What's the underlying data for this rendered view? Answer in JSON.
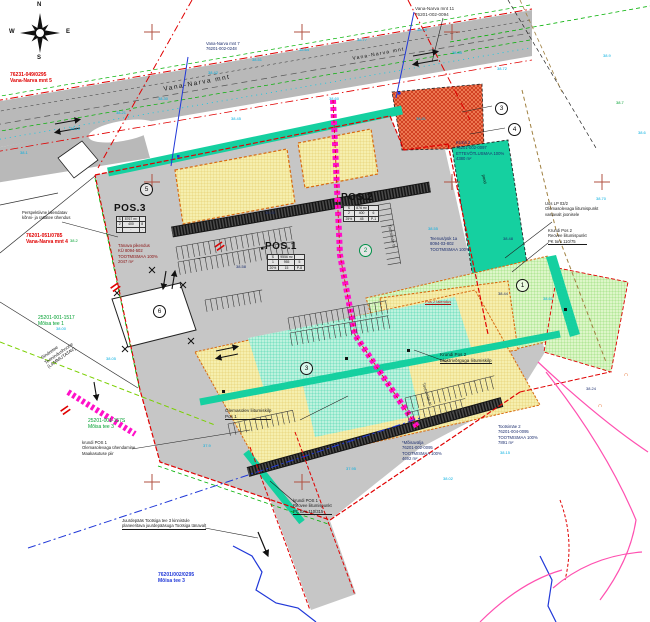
{
  "map": {
    "compass": {
      "n": "N",
      "e": "E",
      "s": "S",
      "w": "W"
    },
    "pos": {
      "pos1": {
        "label": "POS.1",
        "table": [
          [
            "S",
            "9556 m²",
            ""
          ],
          [
            "1",
            "955",
            "5"
          ],
          [
            "20%",
            "15",
            "P-8"
          ]
        ]
      },
      "pos2": {
        "label": "POS.2",
        "table": [
          [
            "S",
            "876 m²",
            ""
          ],
          [
            "2",
            "400",
            "6"
          ],
          [
            "25%",
            "45",
            "P-1"
          ]
        ]
      },
      "pos3": {
        "label": "POS.3",
        "table": [
          [
            "S",
            "8767 m²",
            ""
          ],
          [
            "2",
            "400",
            "8"
          ],
          [
            "·",
            "·",
            "·"
          ]
        ]
      }
    },
    "annotations": [
      {
        "n": "label-vana-narva-mnt-5",
        "x": 10,
        "y": 72,
        "c": "#e00000",
        "s": 5,
        "b": 1,
        "lines": [
          "76231-049/0295",
          "Vana-Narva mnt 5"
        ]
      },
      {
        "n": "label-vana-narva-mnt-4",
        "x": 26,
        "y": 233,
        "c": "#e00000",
        "s": 5,
        "b": 1,
        "lines": [
          "76201-051/0785",
          "Vana-Narva mnt 4"
        ]
      },
      {
        "n": "label-moisa-tee-1",
        "x": 38,
        "y": 315,
        "c": "#00a030",
        "s": 5,
        "lines": [
          "25201-001-1517",
          "Mõisa tee 1"
        ]
      },
      {
        "n": "label-moisa-tee-3-green",
        "x": 88,
        "y": 418,
        "c": "#00a030",
        "s": 5,
        "lines": [
          "25201-001-157S",
          "Mõisa tee 3"
        ]
      },
      {
        "n": "label-moisa-tee-3-blue",
        "x": 158,
        "y": 572,
        "c": "#2038d8",
        "s": 5,
        "b": 1,
        "lines": [
          "76201/002/0295",
          "Mõisa tee 3"
        ]
      },
      {
        "n": "label-vana-narva-mnt-11",
        "x": 415,
        "y": 6,
        "c": "#303030",
        "s": 4.6,
        "lines": [
          "Vana-Narva mnt 11",
          "76201-002-0094"
        ]
      },
      {
        "n": "label-vana-narva-mnt-7",
        "x": 206,
        "y": 41,
        "c": "#1c2e6e",
        "s": 4.2,
        "lines": [
          "Vana-Narva mnt 7",
          "76201-002-0248"
        ]
      },
      {
        "n": "label-krohli-2",
        "x": 456,
        "y": 140,
        "c": "#1c2e6e",
        "s": 4.2,
        "lines": [
          "Krohli 2",
          "76201-002-0097",
          "ETTEVÕTLUSMAA 100%",
          "4380 m²"
        ]
      },
      {
        "n": "label-teenuspuk-1a",
        "x": 430,
        "y": 236,
        "c": "#1c2e6e",
        "s": 4.2,
        "lines": [
          "Teenus/pük 1a",
          "8094-03-802",
          "TOOTMISMAA 100%"
        ]
      },
      {
        "n": "label-uus-lp",
        "x": 545,
        "y": 201,
        "c": "#1a1a1a",
        "s": 4.2,
        "lines": [
          "Uus LP 03/2",
          "Olemasolevaga liitumispunkt",
          "vastavalt joonisele"
        ]
      },
      {
        "n": "label-pos2-reovee",
        "x": 548,
        "y": 228,
        "c": "#1a1a1a",
        "s": 4.2,
        "u": 1,
        "lines": [
          "Krundi Pos 2",
          "Reovee liitumispunkt",
          "PK toru 110/75"
        ]
      },
      {
        "n": "label-pos2-elekter",
        "x": 440,
        "y": 352,
        "c": "#1a1a1a",
        "s": 4.6,
        "u": 1,
        "lines": [
          "Krundi Pos 2",
          "Elektrivõrguga liitumiskilp"
        ]
      },
      {
        "n": "label-olemasolev-kilp",
        "x": 225,
        "y": 408,
        "c": "#1a1a1a",
        "s": 4.6,
        "u": 1,
        "lines": [
          "Olemasolev liitumiskilp",
          "Pos 1"
        ]
      },
      {
        "n": "label-pos1-reovee",
        "x": 293,
        "y": 498,
        "c": "#1a1a1a",
        "s": 4.2,
        "u": 1,
        "lines": [
          "krundi POS 1",
          "Reovee liitumispunkt",
          "PC toru 110/315"
        ]
      },
      {
        "n": "label-tootsimae-2",
        "x": 498,
        "y": 424,
        "c": "#1c2e6e",
        "s": 4.2,
        "lines": [
          "Tootsimäe 2",
          "76201-004-0095",
          "TOOTMISMAA 100%",
          "7891 m²"
        ]
      },
      {
        "n": "label-moisavalja",
        "x": 402,
        "y": 440,
        "c": "#1c2e6e",
        "s": 4.2,
        "lines": [
          "*Mõisavälja",
          "76201-002-0095",
          "TOOTMISMAA 100%",
          "4692 m²"
        ]
      },
      {
        "n": "label-perspektiivne",
        "x": 22,
        "y": 210,
        "c": "#1a1a1a",
        "s": 4.2,
        "lines": [
          "Perspektiivne laiendatav",
          "kõnni- ja rattatee ühendus"
        ]
      },
      {
        "n": "label-tanava-pikendus",
        "x": 118,
        "y": 243,
        "c": "#8a1010",
        "s": 4.2,
        "lines": [
          "Tänava pikendus",
          "KÜ 8094-502",
          "TOOTMISMAA 100%",
          "2047 m²"
        ]
      },
      {
        "n": "label-juurdepaas",
        "x": 122,
        "y": 518,
        "c": "#1a1a1a",
        "s": 4.2,
        "u": 1,
        "lines": [
          "Juurdepääs Tootsiga tee 3 kinnistule",
          "planeeritava juurdepääsuga Tootsiga tänavalt"
        ]
      },
      {
        "n": "label-pos1-uhendamine",
        "x": 82,
        "y": 440,
        "c": "#1a1a1a",
        "s": 4.2,
        "lines": [
          "krundi POS 1",
          "Olemasolevaga ühendamine",
          "Maakasutuse piir"
        ]
      },
      {
        "n": "label-sindretee",
        "x": 40,
        "y": 356,
        "c": "#1a1a1a",
        "s": 4.6,
        "r": -35,
        "lines": [
          "Sindretee",
          "Teenindushoone",
          "(LAMMUTATAV)"
        ]
      },
      {
        "n": "label-road-name",
        "x": 163,
        "y": 86,
        "c": "#111111",
        "s": 6.5,
        "r": -10.5,
        "sp": 1.5,
        "lines": [
          "Vana-Narva  mnt"
        ]
      },
      {
        "n": "label-road-name-2",
        "x": 352,
        "y": 56,
        "c": "#111111",
        "s": 5,
        "r": -10.5,
        "sp": 1.2,
        "lines": [
          "Vana-Narva  mnt"
        ]
      },
      {
        "n": "label-tootsimae-tn",
        "x": 392,
        "y": 224,
        "c": "#333333",
        "s": 4.2,
        "r": 78,
        "lines": [
          "Tootsimäe tn"
        ]
      },
      {
        "n": "label-tootsimae-tn-2",
        "x": 426,
        "y": 382,
        "c": "#333333",
        "s": 4.2,
        "r": 72,
        "lines": [
          "Tootsimäe tn"
        ]
      },
      {
        "n": "label-pood",
        "x": 486,
        "y": 174,
        "c": "#111111",
        "s": 4.2,
        "r": 78,
        "lines": [
          "pood"
        ]
      },
      {
        "n": "label-pos2-laiendus",
        "x": 425,
        "y": 299,
        "c": "#b01010",
        "s": 4,
        "u": 1,
        "lines": [
          "Pos 2 laiendus"
        ]
      },
      {
        "n": "utility-symbol-1",
        "x": 624,
        "y": 372,
        "c": "#e05000",
        "s": 6,
        "lines": [
          "∩"
        ]
      },
      {
        "n": "utility-symbol-2",
        "x": 598,
        "y": 403,
        "c": "#e05000",
        "s": 6,
        "lines": [
          "∩"
        ]
      }
    ],
    "spot_elevations": [
      [
        208,
        70,
        "38.42"
      ],
      [
        252,
        57,
        "38.51"
      ],
      [
        299,
        47,
        "38.64"
      ],
      [
        357,
        37,
        "38.77"
      ],
      [
        417,
        27,
        "38.90"
      ],
      [
        452,
        50,
        "38.85"
      ],
      [
        497,
        66,
        "38.72"
      ],
      [
        158,
        96,
        "38.30"
      ],
      [
        116,
        110,
        "38.21"
      ],
      [
        70,
        126,
        "38.10"
      ],
      [
        231,
        116,
        "38.45"
      ],
      [
        329,
        96,
        "38.60"
      ],
      [
        265,
        210,
        "38.40",
        "#1c2e6e"
      ],
      [
        428,
        226,
        "38.55"
      ],
      [
        503,
        236,
        "38.48",
        "#1c2e6e"
      ],
      [
        543,
        296,
        "38.61"
      ],
      [
        596,
        196,
        "38.70"
      ],
      [
        346,
        466,
        "37.95"
      ],
      [
        443,
        476,
        "38.02"
      ],
      [
        500,
        450,
        "38.15"
      ],
      [
        106,
        356,
        "38.05"
      ],
      [
        56,
        326,
        "38.00"
      ],
      [
        586,
        386,
        "38.24",
        "#1c2e6e"
      ],
      [
        236,
        264,
        "38.58",
        "#1c2e6e"
      ],
      [
        498,
        291,
        "38.44",
        "#1c2e6e"
      ],
      [
        416,
        116,
        "38.81"
      ],
      [
        616,
        100,
        "38.7",
        "#00a030"
      ],
      [
        70,
        238,
        "38.2",
        "#00a030"
      ],
      [
        203,
        443,
        "37.9"
      ],
      [
        603,
        53,
        "38.9"
      ],
      [
        638,
        130,
        "38.6"
      ],
      [
        20,
        150,
        "38.1"
      ]
    ],
    "circled_numbers": [
      {
        "t": "1",
        "x": 516,
        "y": 279
      },
      {
        "t": "2",
        "x": 359,
        "y": 244,
        "c": "#009048"
      },
      {
        "t": "3",
        "x": 495,
        "y": 102
      },
      {
        "t": "4",
        "x": 508,
        "y": 123
      },
      {
        "t": "5",
        "x": 140,
        "y": 183
      },
      {
        "t": "6",
        "x": 153,
        "y": 305
      },
      {
        "t": "3",
        "x": 300,
        "y": 362
      }
    ],
    "survey_crosses": [
      [
        152,
        32
      ],
      [
        302,
        32
      ],
      [
        452,
        32
      ],
      [
        152,
        182
      ],
      [
        452,
        182
      ],
      [
        602,
        182
      ],
      [
        152,
        482
      ],
      [
        302,
        482
      ]
    ],
    "parking_combs": [
      {
        "x": 176,
        "y": 247,
        "r": -10,
        "len": 118,
        "d": 13,
        "st": 5.5
      },
      {
        "x": 178,
        "y": 262,
        "r": -10,
        "len": 118,
        "d": 13,
        "st": 5.5
      },
      {
        "x": 288,
        "y": 318,
        "r": -10,
        "len": 100,
        "d": 13,
        "st": 5.5
      },
      {
        "x": 290,
        "y": 333,
        "r": -10,
        "len": 100,
        "d": 13,
        "st": 5.5
      },
      {
        "x": 405,
        "y": 398,
        "r": -14,
        "len": 92,
        "d": 13,
        "st": 5.5
      },
      {
        "x": 407,
        "y": 413,
        "r": -14,
        "len": 60,
        "d": 12,
        "st": 5.5
      },
      {
        "x": 390,
        "y": 203,
        "r": 80,
        "len": 62,
        "d": 13,
        "st": 5.5
      },
      {
        "x": 205,
        "y": 300,
        "r": -10,
        "len": 58,
        "d": 12,
        "st": 5.5
      },
      {
        "x": 228,
        "y": 424,
        "r": -12,
        "len": 66,
        "d": 12,
        "st": 5.5
      }
    ],
    "colors": {
      "boundary_red": "#e00000",
      "magenta": "#ff10c8",
      "teal": "#15d0a0",
      "green_zone": "#ddf6c8",
      "yellow_zone": "#f6efae",
      "orange_parcel": "#f2825a",
      "road_gray": "#b9b9b9",
      "site_gray": "#c6c6c6",
      "cyan_text": "#00aee0",
      "green_text": "#00a030",
      "blue": "#2038d8"
    }
  }
}
